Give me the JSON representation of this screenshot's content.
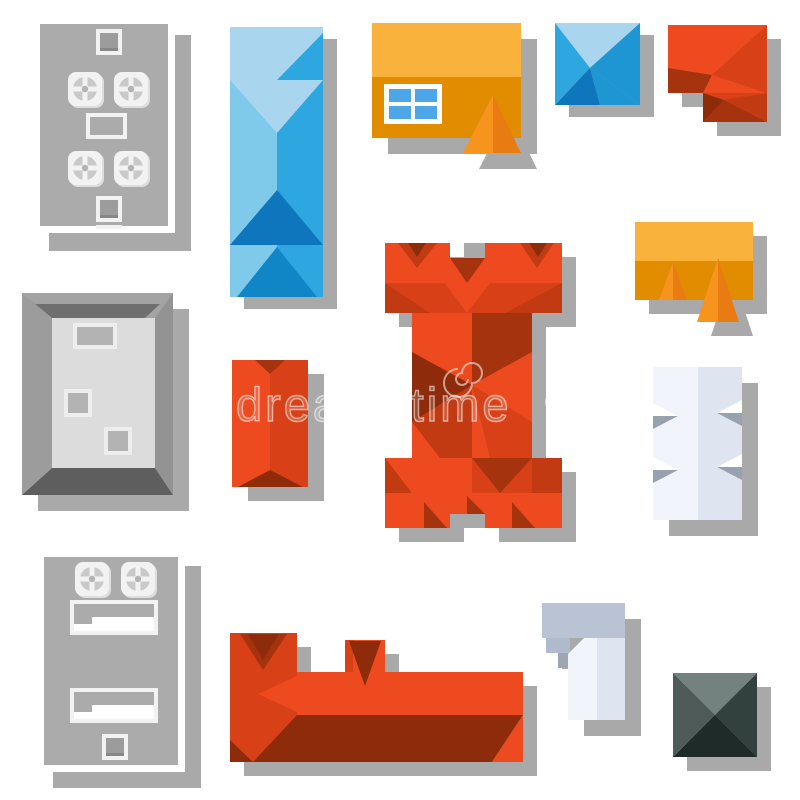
{
  "canvas": {
    "width": 800,
    "height": 800,
    "background": "#ffffff"
  },
  "watermark": {
    "text": "dreamstime",
    "logo": "spiral"
  },
  "palette": {
    "white": "#ffffff",
    "shadow": "#a9a9a9",
    "roof_gray": "#ababab",
    "vent_white": "#f2f2f2",
    "vent_shadow": "#dddddd",
    "vent_gray": "#c9c9c9",
    "vent_dark": "#9c9c9c",
    "vent_line": "#878787",
    "frame_gray": "#a3a3a3",
    "frame_top": "#6f6f6f",
    "frame_bottom": "#5e5e5e",
    "frame_left": "#9c9c9c",
    "frame_right": "#939393",
    "frame_inner": "#dcdcdc",
    "sky_frame": "#ededed",
    "sky_fill": "#b3b3b3",
    "blue_pale": "#a9d6ee",
    "blue_soft": "#7fc9ea",
    "blue": "#2ea7e0",
    "blue_mid": "#1e96d4",
    "blue_deep": "#0e76bc",
    "blue_dark2": "#1186c7",
    "yellow": "#f9b23b",
    "amber": "#e28c00",
    "orange": "#f7941e",
    "orange_deep": "#e87b12",
    "window_blue": "#4da6e8",
    "red": "#ee4a1f",
    "red_mid": "#d84017",
    "red_dark": "#c23a12",
    "maroon": "#a5330e",
    "maroon_deep": "#8e2b0a",
    "slate_top": "#73827f",
    "slate_left": "#4e5b59",
    "slate_right": "#32403e",
    "slate_dark": "#1f2b29",
    "paper_left": "#f1f4fa",
    "paper_right": "#dee4f0",
    "bar_gray": "#b9c3d3",
    "step_gray": "#afbacc",
    "step_dark": "#9fa5b1",
    "notch_gray": "#97a1b0"
  },
  "items": [
    {
      "name": "flat-roof-building-vents-large-icon"
    },
    {
      "name": "blue-gable-roof-icon"
    },
    {
      "name": "yellow-house-skylight-dormer-icon"
    },
    {
      "name": "blue-hip-roof-icon"
    },
    {
      "name": "orange-l-shaped-roof-icon"
    },
    {
      "name": "parapet-roof-building-icon"
    },
    {
      "name": "red-gable-roof-small-icon"
    },
    {
      "name": "orange-castle-roof-icon"
    },
    {
      "name": "yellow-house-two-dormers-icon"
    },
    {
      "name": "white-notched-roof-icon"
    },
    {
      "name": "flat-roof-building-vents-small-icon"
    },
    {
      "name": "orange-long-roof-towers-icon"
    },
    {
      "name": "white-t-shaped-building-icon"
    },
    {
      "name": "dark-pyramid-roof-icon"
    }
  ]
}
